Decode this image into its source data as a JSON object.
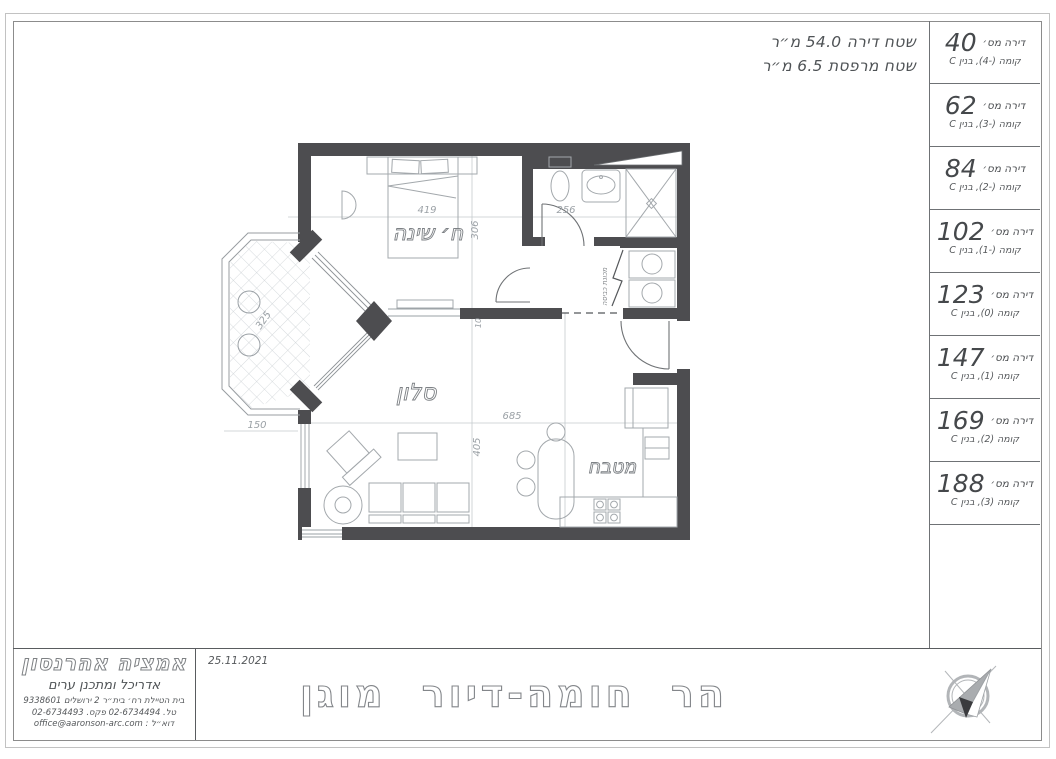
{
  "sheet": {
    "area_note": {
      "line1": "שטח דירה  54.0 מ״ר",
      "line2": "שטח מרפסת 6.5 מ״ר"
    },
    "apartments": {
      "num_label": "דירה מס׳",
      "rows": [
        {
          "number": "40",
          "floor": "קומה (-4), בנין C"
        },
        {
          "number": "62",
          "floor": "קומה (-3), בנין C"
        },
        {
          "number": "84",
          "floor": "קומה (-2), בנין C"
        },
        {
          "number": "102",
          "floor": "קומה (-1), בנין C"
        },
        {
          "number": "123",
          "floor": "קומה (0), בנין C"
        },
        {
          "number": "147",
          "floor": "קומה (1), בנין C"
        },
        {
          "number": "169",
          "floor": "קומה (2), בנין C"
        },
        {
          "number": "188",
          "floor": "קומה (3), בנין C"
        }
      ]
    },
    "plan": {
      "labels": {
        "bedroom": "ח׳ שינה",
        "living": "סלון",
        "kitchen": "מטבח",
        "washer": "מכונת כביסה"
      },
      "dims": {
        "d419": "419",
        "d306": "306",
        "d256": "256",
        "d325": "325",
        "d150": "150",
        "d685": "685",
        "d405": "405",
        "d10": "10"
      }
    },
    "titleblock": {
      "architect_name": "אמציה אהרנסון",
      "architect_role": "אדריכל ומתכנן ערים",
      "address": "בית הטיילת רח׳ בית״ר 2 ירושלים 9338601",
      "phones": "טל. 02-6734494 פקס. 02-6734493",
      "email_line": "דוא״ל : office@aaronson-arc.com",
      "date": "25.11.2021",
      "project_title": "הר חומה-דיור מוגן"
    },
    "colors": {
      "wall": "#4d4d50",
      "thin_line": "#9aa0a5",
      "hatch": "#ccd1d5"
    }
  }
}
